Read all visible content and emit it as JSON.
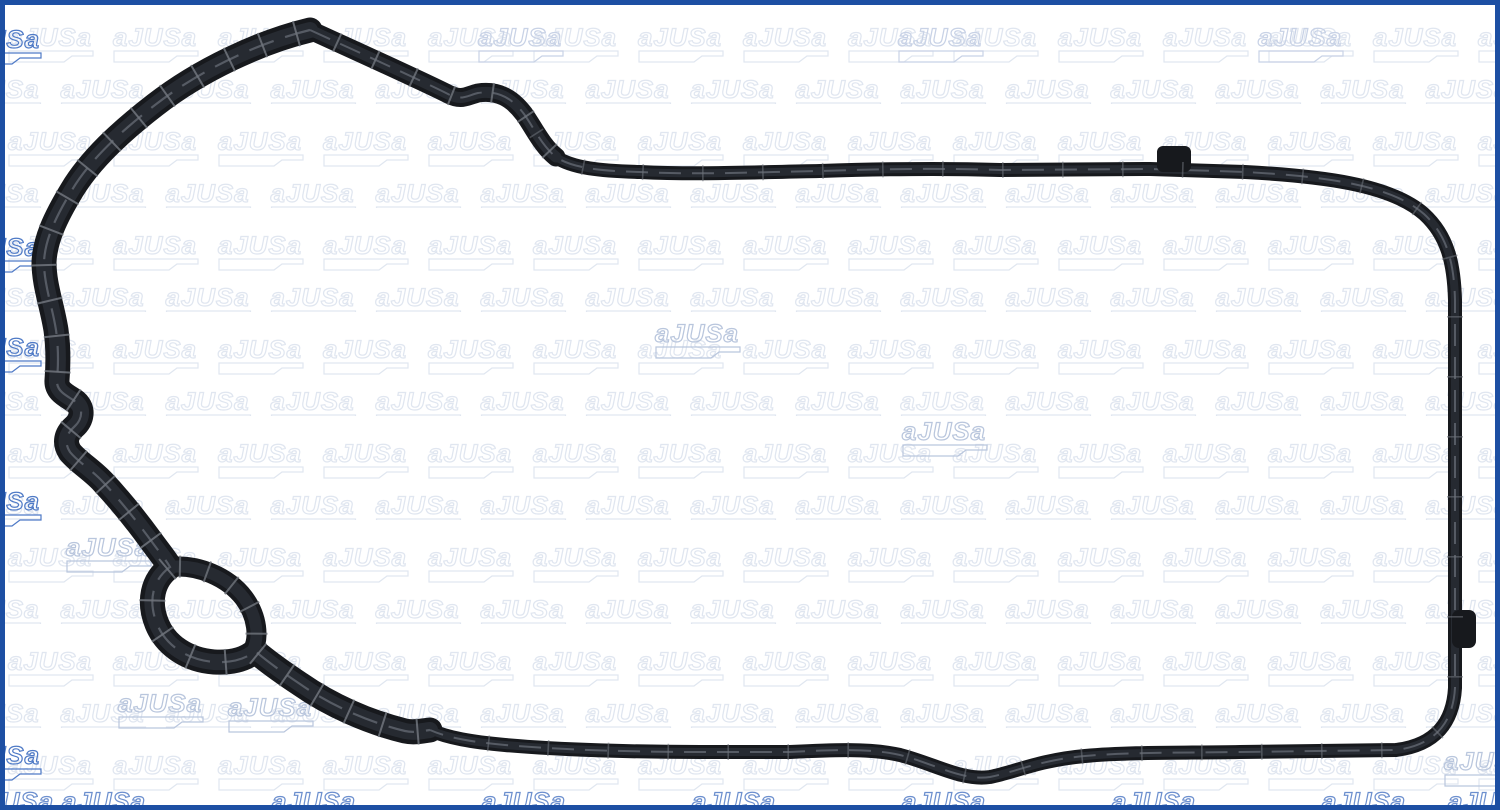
{
  "image": {
    "width": 1500,
    "height": 810,
    "description": "Product photo of a black rubber engine gasket seal on white background with brand watermark pattern"
  },
  "brand": {
    "name": "AJUSA",
    "watermark_text": "aJUSa"
  },
  "colors": {
    "bg": "#ffffff",
    "border": "#1d4fa3",
    "gasket": "#17191d",
    "gasket_inner": "#262a31",
    "gasket_highlight": "#565b64",
    "gasket_rib": "#70757d",
    "wm_light": "#e0e6f0"
  },
  "watermark": {
    "tile_width": 105,
    "tile_height": 52,
    "accent_groups": [
      {
        "name": "scattered-medium",
        "color": "#b9c6dd",
        "tiles": [
          [
            655,
            320
          ],
          [
            902,
            418
          ],
          [
            66,
            534
          ],
          [
            118,
            690
          ],
          [
            228,
            694
          ],
          [
            1444,
            748
          ]
        ]
      },
      {
        "name": "left-edge",
        "color": "#4f7ac6",
        "tiles": [
          [
            -44,
            26
          ],
          [
            -44,
            234
          ],
          [
            -44,
            334
          ],
          [
            -44,
            488
          ],
          [
            -44,
            742
          ]
        ]
      },
      {
        "name": "bottom-edge",
        "color": "#6c8fce",
        "tiles": [
          [
            -30,
            788
          ],
          [
            62,
            788
          ],
          [
            272,
            788
          ],
          [
            482,
            788
          ],
          [
            692,
            788
          ],
          [
            902,
            788
          ],
          [
            1112,
            788
          ],
          [
            1322,
            788
          ],
          [
            1448,
            788
          ]
        ]
      },
      {
        "name": "top-edge",
        "color": "#c8d2e6",
        "tiles": [
          [
            478,
            24
          ],
          [
            898,
            24
          ],
          [
            1258,
            24
          ]
        ]
      }
    ]
  },
  "gasket": {
    "thin_path": "M310 30 C380 62 420 80 448 94 C462 101 466 96 478 93 C498 90 512 98 524 114 C534 128 542 146 556 157 C572 168 600 171 640 172 C700 175 760 172 820 171 C880 169 940 168 1000 170 L1150 169 C1185 170 1215 171 1245 172 C1320 176 1390 184 1424 214 C1448 236 1454 264 1455 300 L1455 688 C1453 722 1436 745 1396 750 L1240 752 C1180 753 1130 752 1085 756 C1040 760 1015 772 990 777 C962 781 935 764 900 755 C870 748 830 750 790 752 L700 752 C640 752 560 750 505 745 C472 742 448 738 430 730",
    "thick_path": "M310 30 C260 42 200 70 155 105 C120 132 90 160 72 190 C55 218 45 240 44 262 C44 285 52 305 56 330 C59 352 58 368 57 380 C56 392 68 396 76 402 C84 409 82 420 74 427 C66 434 64 443 70 452 C78 462 92 470 103 482 C118 498 136 520 152 542 C160 553 166 560 170 567 C152 580 148 602 157 624 C166 646 188 660 214 662 C232 663 246 659 255 651 C268 662 282 672 300 684 C330 705 368 722 405 731 C414 733 422 731 430 730",
    "slope_path": "M310 30 C380 62 420 80 448 94 C462 101 466 96 478 93 C498 90 512 98 524 114 C534 128 542 146 556 157",
    "eyelet_upper_path": "M170 567 C198 564 228 577 244 598 C258 617 259 638 253 650",
    "tabs": [
      {
        "x": 1157,
        "y": 146,
        "w": 34,
        "h": 26,
        "rx": 6
      },
      {
        "x": 1452,
        "y": 610,
        "w": 24,
        "h": 38,
        "rx": 7
      }
    ],
    "ribs": {
      "thick_step": 36,
      "thick_half": 13,
      "thin_step": 60,
      "thin_half": 8,
      "thin_start": 260,
      "eyelet_step": 28,
      "eyelet_half": 11
    }
  }
}
